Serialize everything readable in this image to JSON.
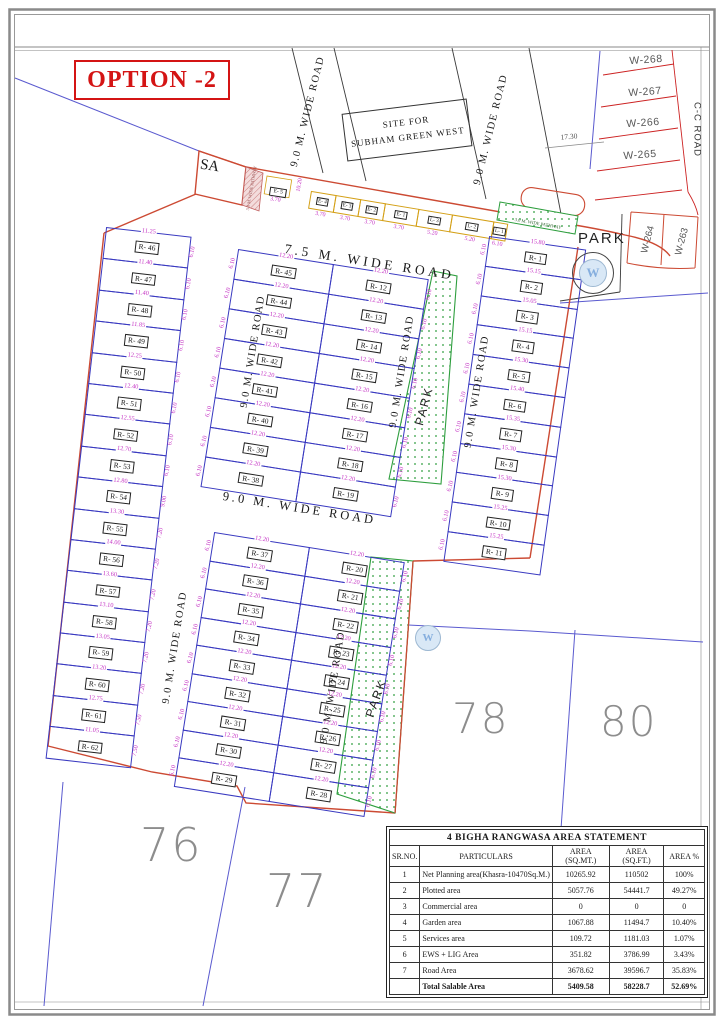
{
  "title": "OPTION -2",
  "site_box": {
    "line1": "SITE FOR",
    "line2": "SUBHAM GREEN WEST"
  },
  "labels": {
    "sa": "SA",
    "park": "PARK",
    "road_75": "7.5 M. WIDE ROAD",
    "road_90": "9.0 M. WIDE ROAD",
    "cc_road": "C-C ROAD",
    "pathway": "3.0 M. WIDE PATHWAY",
    "w_badge": "W"
  },
  "khasra": [
    "76",
    "77",
    "78",
    "80"
  ],
  "w_plots_top": [
    "W-268",
    "W-267",
    "W-266",
    "W-265"
  ],
  "w_plots_side": [
    "W-264",
    "W-263"
  ],
  "dims": {
    "corner": "17.30",
    "e5_width": "3.70",
    "e5_depth": "10.20"
  },
  "e5_label": "E- 5",
  "ews_row": [
    {
      "label": "E- 4",
      "dim": "3.70"
    },
    {
      "label": "E- 3",
      "dim": "3.70"
    },
    {
      "label": "E- 2",
      "dim": "3.70"
    },
    {
      "label": "E- 1",
      "dim": "3.70"
    },
    {
      "label": "L- 3",
      "dim": "5.20"
    },
    {
      "label": "L- 2",
      "dim": "5.20"
    },
    {
      "label": "L- 1",
      "dim": "6.10"
    }
  ],
  "left_column": [
    {
      "label": "R- 46",
      "top": "11.25",
      "side": "6.10"
    },
    {
      "label": "R- 47",
      "top": "11.40",
      "side": "6.10"
    },
    {
      "label": "R- 48",
      "top": "11.40",
      "side": "6.10"
    },
    {
      "label": "R- 49",
      "top": "11.85",
      "side": "6.10"
    },
    {
      "label": "R- 50",
      "top": "12.25",
      "side": "6.10"
    },
    {
      "label": "R- 51",
      "top": "12.40",
      "side": "6.10"
    },
    {
      "label": "R- 52",
      "top": "12.55",
      "side": "6.10"
    },
    {
      "label": "R- 53",
      "top": "12.70",
      "side": "6.10"
    },
    {
      "label": "R- 54",
      "top": "12.80",
      "side": "9.00"
    },
    {
      "label": "R- 55",
      "top": "13.30",
      "side": "7.20"
    },
    {
      "label": "R- 56",
      "top": "14.00",
      "side": "7.20"
    },
    {
      "label": "R- 57",
      "top": "13.60",
      "side": "7.20"
    },
    {
      "label": "R- 58",
      "top": "13.10",
      "side": "7.20"
    },
    {
      "label": "R- 59",
      "top": "13.05",
      "side": "7.20"
    },
    {
      "label": "R- 60",
      "top": "13.20",
      "side": "7.20"
    },
    {
      "label": "R- 61",
      "top": "12.75",
      "side": "7.50"
    },
    {
      "label": "R- 62",
      "top": "11.05",
      "side": "7.50"
    }
  ],
  "mid_upper_left": [
    {
      "label": "R- 45",
      "top": "12.20",
      "side": "6.10"
    },
    {
      "label": "R- 44",
      "top": "12.20",
      "side": "6.10"
    },
    {
      "label": "R- 43",
      "top": "12.20",
      "side": "6.10"
    },
    {
      "label": "R- 42",
      "top": "12.20",
      "side": "6.10"
    },
    {
      "label": "R- 41",
      "top": "12.20",
      "side": "6.10"
    },
    {
      "label": "R- 40",
      "top": "12.20",
      "side": "6.10"
    },
    {
      "label": "R- 39",
      "top": "12.20",
      "side": "6.10"
    },
    {
      "label": "R- 38",
      "top": "12.20",
      "side": "6.10"
    }
  ],
  "mid_upper_right": [
    {
      "label": "R- 12",
      "top": "12.20",
      "side": "6.10"
    },
    {
      "label": "R- 13",
      "top": "12.20",
      "side": "6.10"
    },
    {
      "label": "R- 14",
      "top": "12.20",
      "side": "6.10"
    },
    {
      "label": "R- 15",
      "top": "12.20",
      "side": "6.10"
    },
    {
      "label": "R- 16",
      "top": "12.20",
      "side": "6.10"
    },
    {
      "label": "R- 17",
      "top": "12.20",
      "side": "6.10"
    },
    {
      "label": "R- 18",
      "top": "12.20",
      "side": "6.10"
    },
    {
      "label": "R- 19",
      "top": "12.20",
      "side": "6.10"
    }
  ],
  "mid_lower_left": [
    {
      "label": "R- 37",
      "top": "12.20",
      "side": "6.10"
    },
    {
      "label": "R- 36",
      "top": "12.20",
      "side": "6.10"
    },
    {
      "label": "R- 35",
      "top": "12.20",
      "side": "6.10"
    },
    {
      "label": "R- 34",
      "top": "12.20",
      "side": "6.10"
    },
    {
      "label": "R- 33",
      "top": "12.20",
      "side": "6.10"
    },
    {
      "label": "R- 32",
      "top": "12.20",
      "side": "6.10"
    },
    {
      "label": "R- 31",
      "top": "12.20",
      "side": "6.10"
    },
    {
      "label": "R- 30",
      "top": "12.20",
      "side": "6.10"
    },
    {
      "label": "R- 29",
      "top": "12.20",
      "side": "6.10"
    }
  ],
  "mid_lower_right": [
    {
      "label": "R- 20",
      "top": "12.20",
      "side": "6.10"
    },
    {
      "label": "R- 21",
      "top": "12.20",
      "side": "6.10"
    },
    {
      "label": "R- 22",
      "top": "12.20",
      "side": "6.10"
    },
    {
      "label": "R- 23",
      "top": "12.20",
      "side": "6.10"
    },
    {
      "label": "R- 24",
      "top": "12.20",
      "side": "6.10"
    },
    {
      "label": "R- 25",
      "top": "12.20",
      "side": "6.10"
    },
    {
      "label": "R- 26",
      "top": "12.20",
      "side": "6.10"
    },
    {
      "label": "R- 27",
      "top": "12.20",
      "side": "6.10"
    },
    {
      "label": "R- 28",
      "top": "12.20",
      "side": "6.10"
    }
  ],
  "right_column": [
    {
      "label": "R- 1",
      "top": "15.80",
      "side": "6.10"
    },
    {
      "label": "R- 2",
      "top": "15.15",
      "side": "6.10"
    },
    {
      "label": "R- 3",
      "top": "15.05",
      "side": "6.10"
    },
    {
      "label": "R- 4",
      "top": "15.15",
      "side": "6.10"
    },
    {
      "label": "R- 5",
      "top": "15.30",
      "side": "6.10"
    },
    {
      "label": "R- 6",
      "top": "15.40",
      "side": "6.10"
    },
    {
      "label": "R- 7",
      "top": "15.35",
      "side": "6.10"
    },
    {
      "label": "R- 8",
      "top": "15.30",
      "side": "6.10"
    },
    {
      "label": "R- 9",
      "top": "15.30",
      "side": "6.10"
    },
    {
      "label": "R- 10",
      "top": "15.25",
      "side": "6.10"
    },
    {
      "label": "R- 11",
      "top": "15.25",
      "side": "6.10"
    }
  ],
  "table": {
    "title": "4 BIGHA RANGWASA AREA STATEMENT",
    "headers": [
      "SR.NO.",
      "PARTICULARS",
      "AREA (SQ.MT.)",
      "AREA (SQ.FT.)",
      "AREA %"
    ],
    "rows": [
      [
        "1",
        "Net Planning area(Khasra-10470Sq.M.)",
        "10265.92",
        "110502",
        "100%"
      ],
      [
        "2",
        "Plotted area",
        "5057.76",
        "54441.7",
        "49.27%"
      ],
      [
        "3",
        "Commercial area",
        "0",
        "0",
        "0"
      ],
      [
        "4",
        "Garden area",
        "1067.88",
        "11494.7",
        "10.40%"
      ],
      [
        "5",
        "Services area",
        "109.72",
        "1181.03",
        "1.07%"
      ],
      [
        "6",
        "EWS + LIG Area",
        "351.82",
        "3786.99",
        "3.43%"
      ],
      [
        "7",
        "Road Area",
        "3678.62",
        "39596.7",
        "35.83%"
      ],
      [
        "",
        "Total Salable Area",
        "5409.58",
        "58228.7",
        "52.69%"
      ]
    ]
  }
}
